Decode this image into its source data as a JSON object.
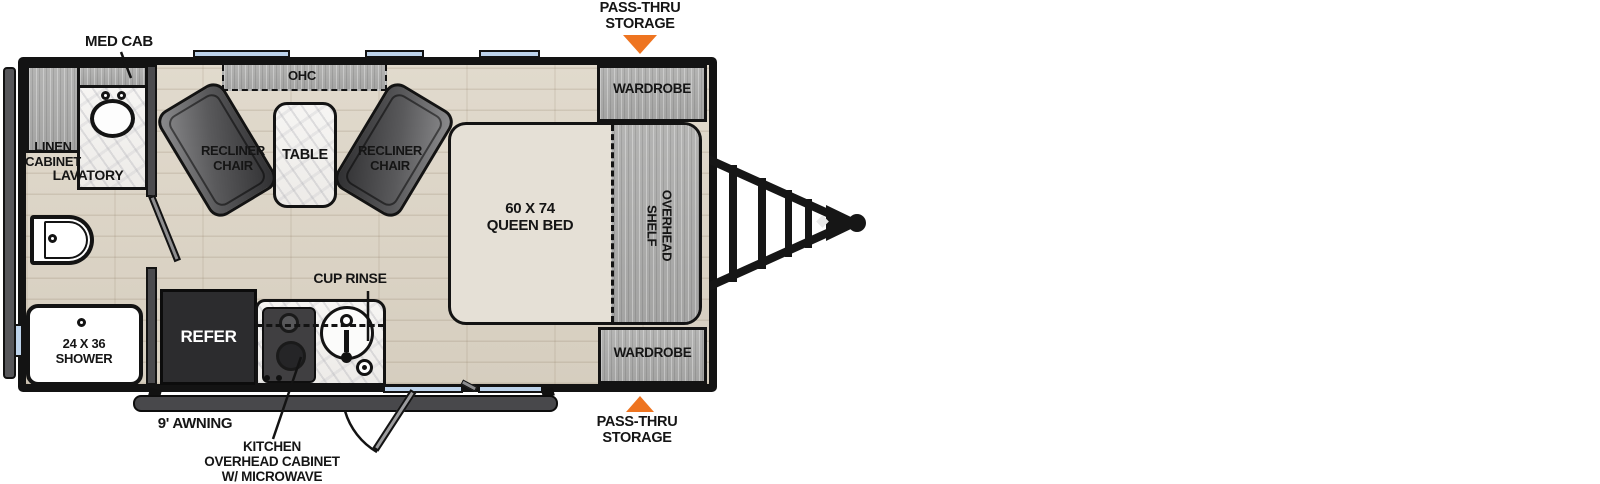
{
  "floorplan": {
    "bathroom": {
      "med_cab": "MED CAB",
      "linen_cabinet": [
        "LINEN",
        "CABINET"
      ],
      "lavatory": "LAVATORY",
      "shower": [
        "24 X 36",
        "SHOWER"
      ]
    },
    "living": {
      "ohc": "OHC",
      "recliner": [
        "RECLINER",
        "CHAIR"
      ],
      "table": "TABLE"
    },
    "bedroom": {
      "bed": [
        "60 X 74",
        "QUEEN BED"
      ],
      "overhead_shelf": [
        "OVERHEAD",
        "SHELF"
      ],
      "wardrobe": "WARDROBE"
    },
    "kitchen": {
      "refer": "REFER",
      "cup_rinse": "CUP RINSE",
      "overhead_cabinet": [
        "KITCHEN",
        "OVERHEAD CABINET",
        "W/ MICROWAVE"
      ]
    },
    "exterior": {
      "awning": "9' AWNING",
      "pass_thru": [
        "PASS-THRU",
        "STORAGE"
      ]
    },
    "colors": {
      "accent_orange": "#EE7420",
      "window_blue": "#BDD3EB",
      "wall_black": "#131313",
      "floor_beige": "#DCD4C6",
      "cabinet_gray": "#ABABAB",
      "bed_beige": "#E5E0D6",
      "chair_gray": "#58585A"
    }
  }
}
